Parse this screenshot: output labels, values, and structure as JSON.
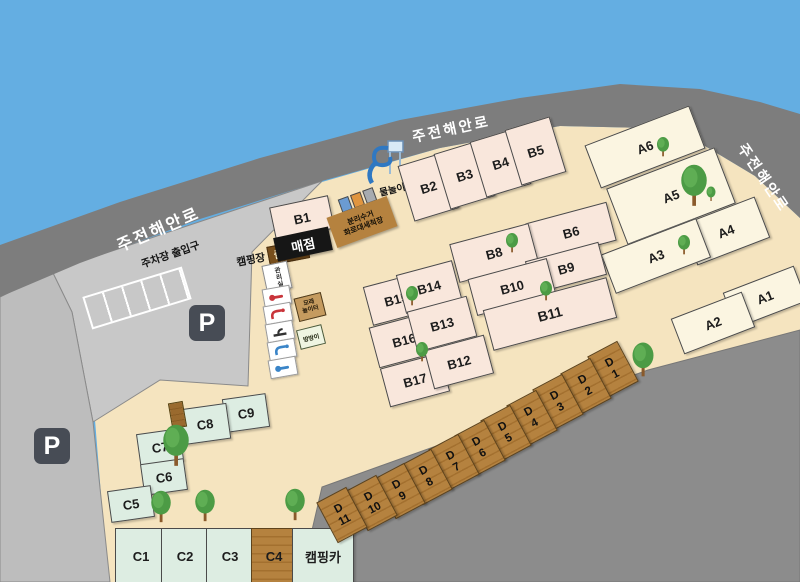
{
  "map": {
    "road_name_left": "주전해안로",
    "road_name_top": "주전해안로",
    "road_name_right": "주전해안로",
    "parking_entrance": "주차장 출입구",
    "camp_entrance_prefix": "캠핑장",
    "camp_entrance_gate": "출입구",
    "parking_symbol": "P"
  },
  "facilities": {
    "store": "매점",
    "office": "관리실",
    "recycle_line1": "분리수거",
    "recycle_line2": "화로대세척장",
    "water_play": "물놀이",
    "sand_line1": "모래",
    "sand_line2": "놀이터",
    "trampoline": "방방이",
    "camping_car": "캠핑카"
  },
  "plots": {
    "a": [
      "A1",
      "A2",
      "A3",
      "A4",
      "A5",
      "A6"
    ],
    "b": [
      "B1",
      "B2",
      "B3",
      "B4",
      "B5",
      "B6",
      "B8",
      "B9",
      "B10",
      "B11",
      "B12",
      "B13",
      "B14",
      "B15",
      "B16",
      "B17"
    ],
    "c": [
      "C1",
      "C2",
      "C3",
      "C4",
      "C5",
      "C6",
      "C7",
      "C8",
      "C9"
    ],
    "d_letter": "D",
    "d_numbers": [
      "1",
      "2",
      "3",
      "4",
      "5",
      "6",
      "7",
      "8",
      "9",
      "10",
      "11"
    ]
  },
  "colors": {
    "water": "#64AEE2",
    "road": "#7D7D7D",
    "ground": "#F5E4BF",
    "parking": "#C8C8C8",
    "zone_a": "#FBF5E1",
    "zone_b": "#F9E7DC",
    "zone_c": "#DDEDE2",
    "wood": "#B5823F"
  }
}
